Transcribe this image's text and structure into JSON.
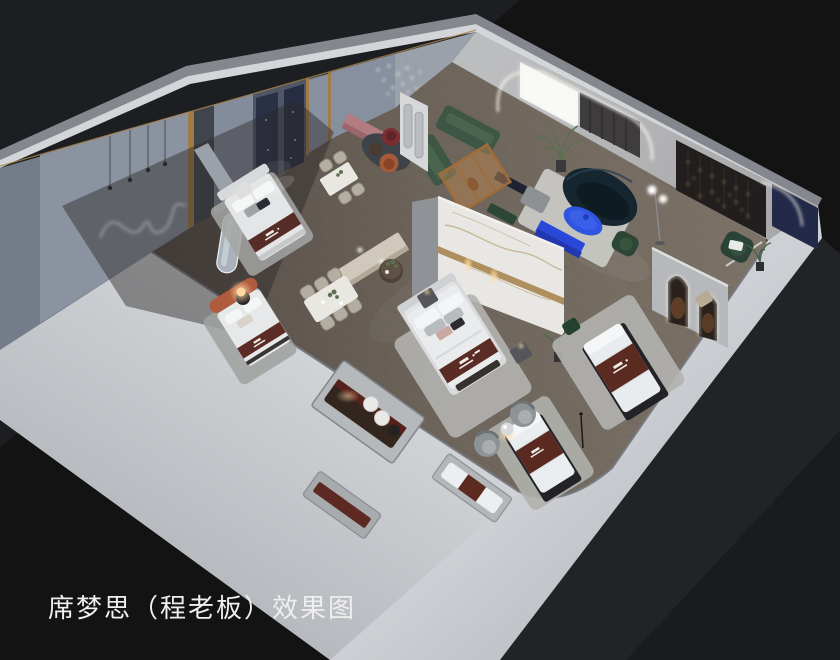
{
  "image": {
    "kind": "3d-isometric-interior-rendering",
    "description": "Top-down isometric cutaway rendering of a Simmons mattress showroom apartment on a black backdrop",
    "width_px": 840,
    "height_px": 660
  },
  "caption": {
    "text": "席梦思（程老板）效果图"
  },
  "palette": {
    "background": "#131313",
    "backdrop_wedge": "#1d1f22",
    "outer_wall_light": "#cbced2",
    "outer_wall_medium": "#9599a0",
    "wall_top_sliver": "#d3d5d8",
    "nw_panel_blue_gray": "#8b93a1",
    "floor_wood": "#6d645b",
    "rug_gray": "#b2b3af",
    "marble_white": "#e9e7e3",
    "brass_trim": "#a8854f",
    "navy_panel": "#2a3147",
    "accent_blue": "#2e54e0",
    "sofa_green": "#3d5646",
    "sofa_dark_teal": "#152630",
    "mattress_runner_burgundy": "#5a2b22",
    "terracotta_headboard": "#b05a3e",
    "sideboard_mauve": "#b27c82",
    "led_glow": "#f8f5e9",
    "lamp_warm": "#ffd9a2"
  },
  "scene": {
    "areas": [
      {
        "name": "left-bedroom-displays",
        "items": [
          "wavy-neon-wall-light",
          "pendant-lights",
          "bed-with-white-headboard",
          "bed-with-terracotta-headboard",
          "glowing-orb-lamp",
          "arched-mirror",
          "navy-headboard-panels",
          "glass-brass-partition"
        ]
      },
      {
        "name": "dining-area",
        "items": [
          "marble-dining-table-six-chairs",
          "marble-dining-table-four-chairs",
          "long-console-with-lamps",
          "round-side-table-with-plant"
        ]
      },
      {
        "name": "lounge",
        "items": [
          "green-sectional-sofa",
          "amber-glass-screen",
          "dark-teal-curved-sofa",
          "blue-oval-coffee-table",
          "blue-media-console",
          "gray-ottoman",
          "green-velvet-chair",
          "mauve-sideboard",
          "red-pouf",
          "rust-chair",
          "white-arch-screen",
          "crystal-pendant-chandelier",
          "backlit-wall-panel",
          "led-arch-portal",
          "string-light-wall",
          "palm-plant",
          "globe-floor-lamp"
        ]
      },
      {
        "name": "center-bed-display",
        "items": [
          "marble-feature-wall-with-brass-band",
          "king-bed-with-branded-runner",
          "nightstands",
          "plant"
        ]
      },
      {
        "name": "right-display",
        "items": [
          "double-arch-led-partition",
          "green-armchair-with-pillow",
          "navy-corner-wall"
        ]
      },
      {
        "name": "floor-mattress-displays",
        "items": [
          "mattress-display-1",
          "mattress-display-2",
          "barrel-chairs",
          "chrome-mushroom-table"
        ]
      },
      {
        "name": "wall-niches",
        "items": [
          "niche-dark-mattress-and-rolled-mattresses",
          "niche-channel-mattress",
          "niche-channel-runner-mattress"
        ]
      }
    ]
  }
}
